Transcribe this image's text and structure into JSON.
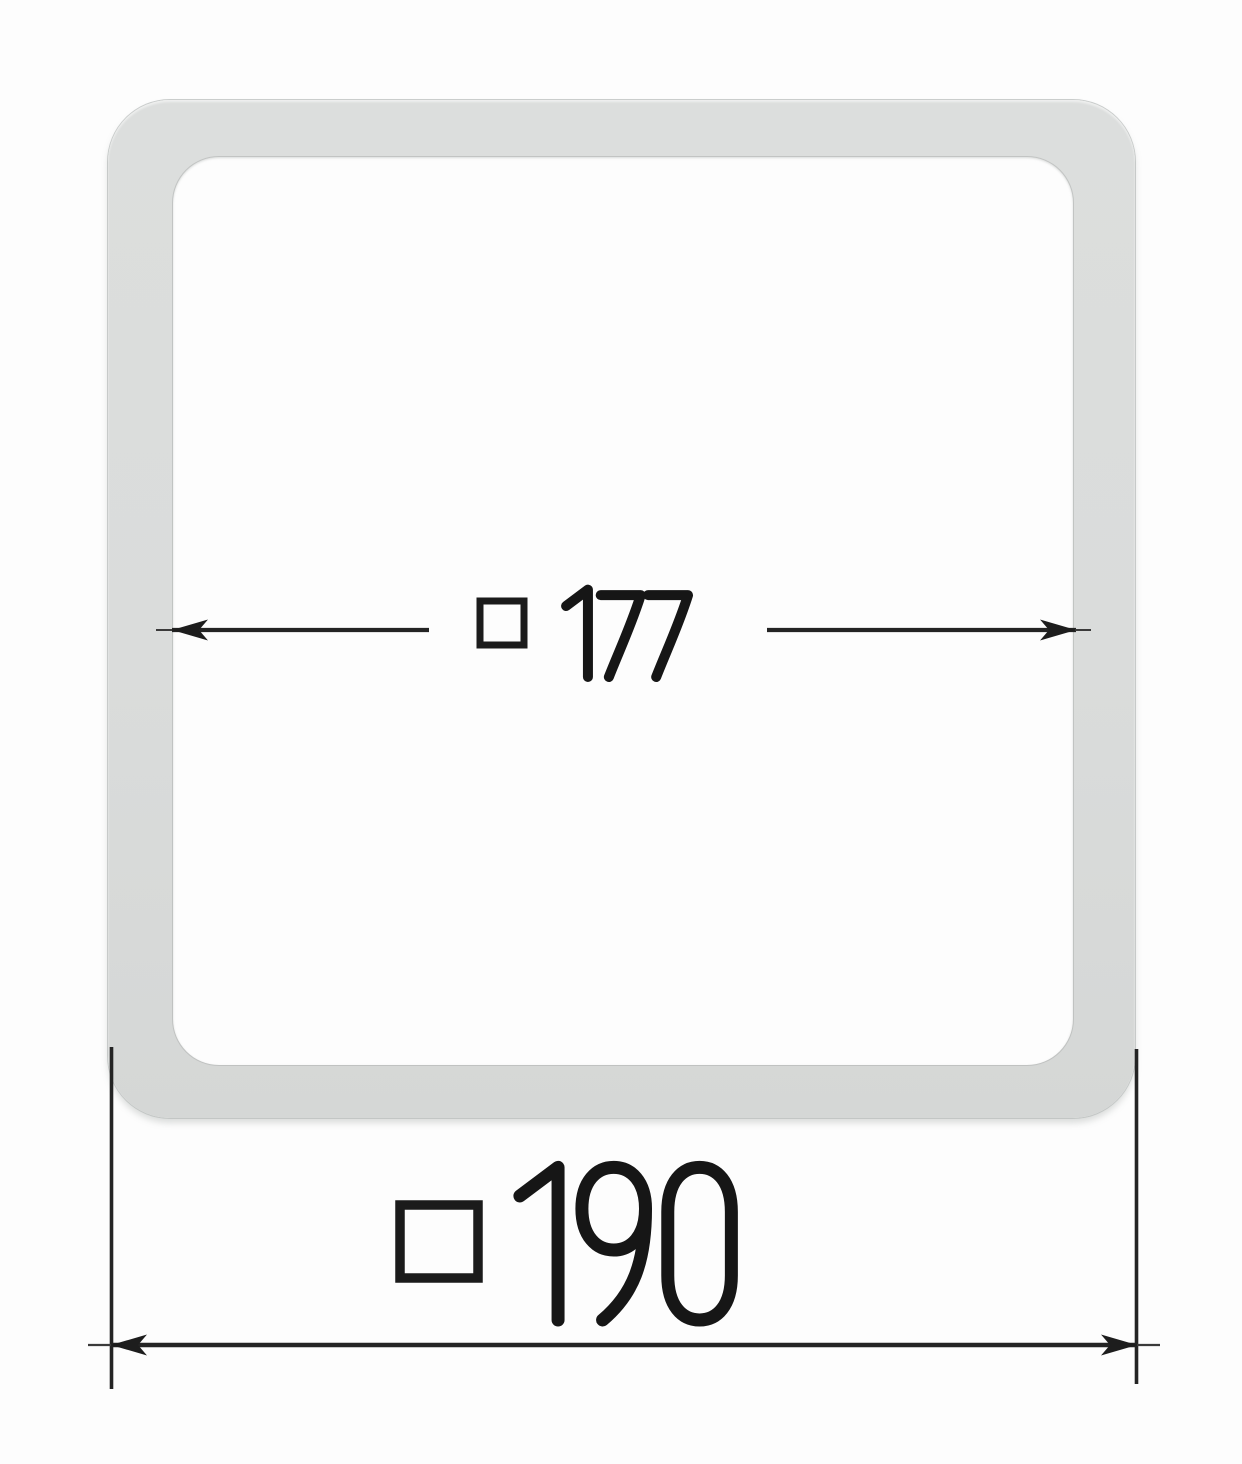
{
  "drawing": {
    "background": "#fdfdfd",
    "frame": {
      "fill": "#dadcdb",
      "edge": "#c3c6c5",
      "shape": "rounded-square-frame"
    },
    "line_color": "#242424",
    "text_color": "#161616",
    "dimensions": {
      "inner": {
        "symbol": "□",
        "value": "177",
        "label": "□ 177"
      },
      "outer": {
        "symbol": "□",
        "value": "190",
        "label": "□ 190"
      }
    }
  }
}
